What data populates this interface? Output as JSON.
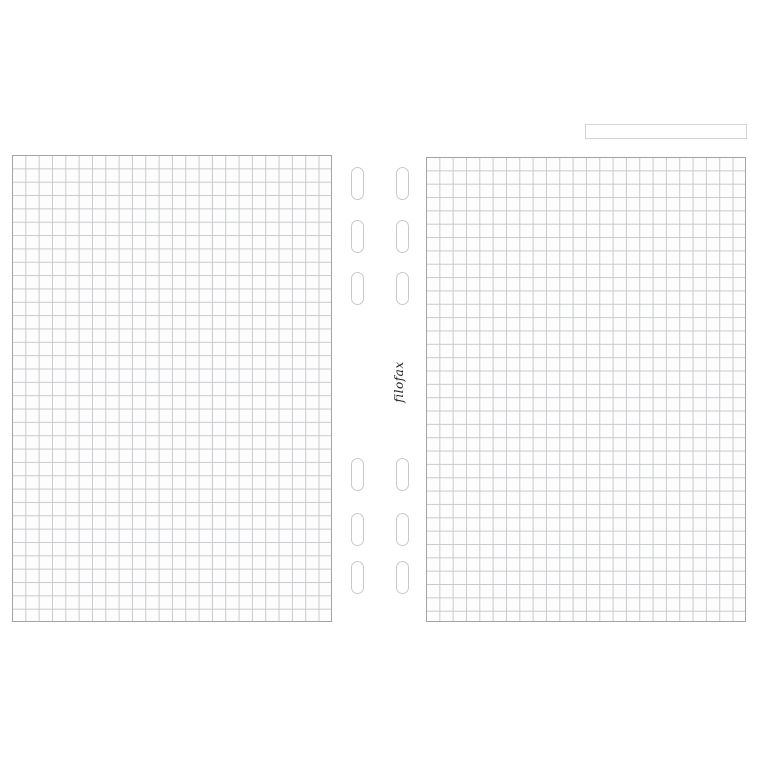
{
  "brand": {
    "logo_text": "filofax"
  },
  "label_box": {
    "value": ""
  },
  "colors": {
    "background": "#ffffff",
    "page_fill": "#fdfdfd",
    "page_border": "#a2a5a7",
    "grid_line": "#c8cacd",
    "hole_outline": "#c9c9c9",
    "label_box_border": "#d4d4d4",
    "brand_text": "#1f1f1f"
  },
  "structure": {
    "pages": [
      "left-grid-sheet",
      "right-grid-sheet"
    ],
    "grid_columns_per_page": 24,
    "grid_rows_per_page": 35,
    "punch_holes_total": 12,
    "punch_hole_columns": 2,
    "punch_hole_groups": [
      "top-group-3-rows",
      "bottom-group-3-rows"
    ]
  }
}
